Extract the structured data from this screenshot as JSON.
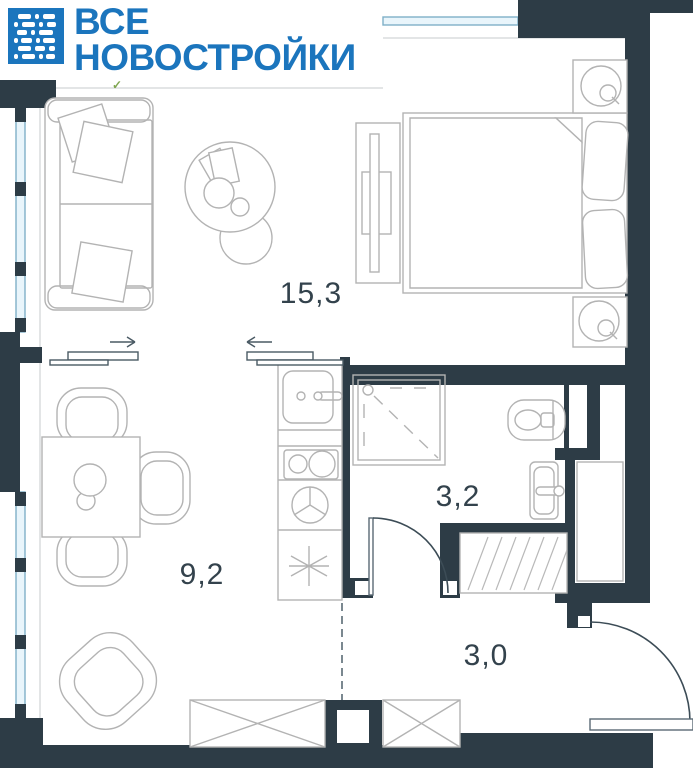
{
  "logo": {
    "line1": "ВСЕ",
    "line2": "НОВОСТРОЙКИ"
  },
  "plan": {
    "type": "apartment-floor-plan",
    "rooms": [
      {
        "name": "living-bedroom",
        "area_label": "15,3"
      },
      {
        "name": "kitchen-living",
        "area_label": "9,2"
      },
      {
        "name": "bathroom",
        "area_label": "3,2"
      },
      {
        "name": "hallway",
        "area_label": "3,0"
      }
    ],
    "annotations": {
      "checkmark": "✓"
    }
  },
  "colors": {
    "brand_blue": "#1b75bd",
    "wall_dark": "#2d3c46",
    "window_fill": "#e9f5fb",
    "window_line": "#7fb0c8",
    "furniture_line": "#b3b3b3",
    "label_text": "#33424c"
  }
}
